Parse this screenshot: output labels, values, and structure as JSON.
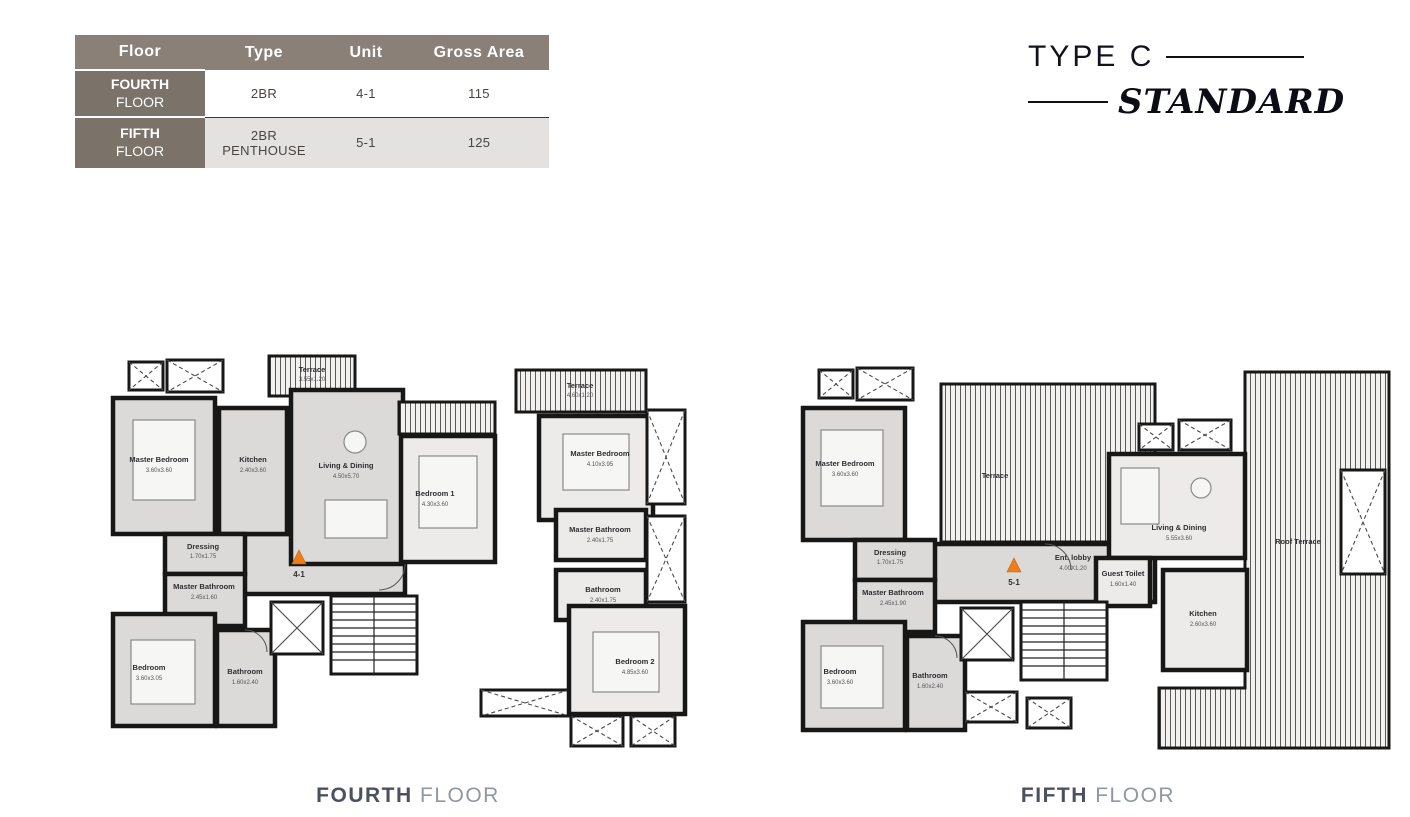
{
  "title": {
    "type_label": "TYPE C",
    "style_label": "STANDARD"
  },
  "table": {
    "headers": {
      "floor": "Floor",
      "type": "Type",
      "unit": "Unit",
      "gross_area": "Gross Area"
    },
    "rows": [
      {
        "floor_top": "FOURTH",
        "floor_bottom": "FLOOR",
        "type": "2BR",
        "unit": "4-1",
        "gross_area": "115"
      },
      {
        "floor_top": "FIFTH",
        "floor_bottom": "FLOOR",
        "type": "2BR PENTHOUSE",
        "unit": "5-1",
        "gross_area": "125"
      }
    ]
  },
  "plans": [
    {
      "caption_primary": "FOURTH",
      "caption_secondary": "FLOOR",
      "unit_marker": "4-1",
      "rooms": {
        "terrace_left": {
          "name": "Terrace",
          "dims": "3.55x1.20"
        },
        "master_bedroom": {
          "name": "Master Bedroom",
          "dims": "3.60x3.60"
        },
        "kitchen": {
          "name": "Kitchen",
          "dims": "2.40x3.60"
        },
        "living_dining": {
          "name": "Living & Dining",
          "dims": "4.50x5.70"
        },
        "dressing": {
          "name": "Dressing",
          "dims": "1.70x1.75"
        },
        "master_bathroom": {
          "name": "Master Bathroom",
          "dims": "2.45x1.60"
        },
        "bedroom": {
          "name": "Bedroom",
          "dims": "3.60x3.05"
        },
        "bathroom": {
          "name": "Bathroom",
          "dims": "1.60x2.40"
        },
        "bedroom1": {
          "name": "Bedroom 1",
          "dims": "4.30x3.60"
        },
        "master_bedroom2": {
          "name": "Master Bedroom",
          "dims": "4.10x3.95"
        },
        "master_bathroom2": {
          "name": "Master Bathroom",
          "dims": "2.40x1.75"
        },
        "bathroom2": {
          "name": "Bathroom",
          "dims": "2.40x1.75"
        },
        "bedroom2": {
          "name": "Bedroom 2",
          "dims": "4.85x3.60"
        },
        "terrace_right": {
          "name": "Terrace",
          "dims": "4.60x1.20"
        }
      }
    },
    {
      "caption_primary": "FIFTH",
      "caption_secondary": "FLOOR",
      "unit_marker": "5-1",
      "rooms": {
        "master_bedroom": {
          "name": "Master Bedroom",
          "dims": "3.60x3.60"
        },
        "terrace": {
          "name": "Terrace"
        },
        "dressing": {
          "name": "Dressing",
          "dims": "1.70x1.75"
        },
        "master_bathroom": {
          "name": "Master Bathroom",
          "dims": "2.45x1.90"
        },
        "ent_lobby": {
          "name": "Ent. lobby",
          "dims": "4.00X1.20"
        },
        "living_dining": {
          "name": "Living & Dining",
          "dims": "5.55x3.60"
        },
        "guest_toilet": {
          "name": "Guest Toilet",
          "dims": "1.60x1.40"
        },
        "kitchen": {
          "name": "Kitchen",
          "dims": "2.60x3.60"
        },
        "bedroom": {
          "name": "Bedroom",
          "dims": "3.60x3.60"
        },
        "bathroom": {
          "name": "Bathroom",
          "dims": "1.60x2.40"
        },
        "roof_terrace": {
          "name": "Roof Terrace"
        }
      }
    }
  ],
  "colors": {
    "table_header_bg": "#8a8078",
    "table_floor_cell_bg": "#7b726a",
    "table_alt_row_bg": "#e3e2e1",
    "unit_marker_orange": "#ee7d1c",
    "caption_primary": "#4b5160",
    "caption_secondary": "#9097a3",
    "plan_wall": "#171717",
    "plan_room_fill": "#dbdad8"
  }
}
